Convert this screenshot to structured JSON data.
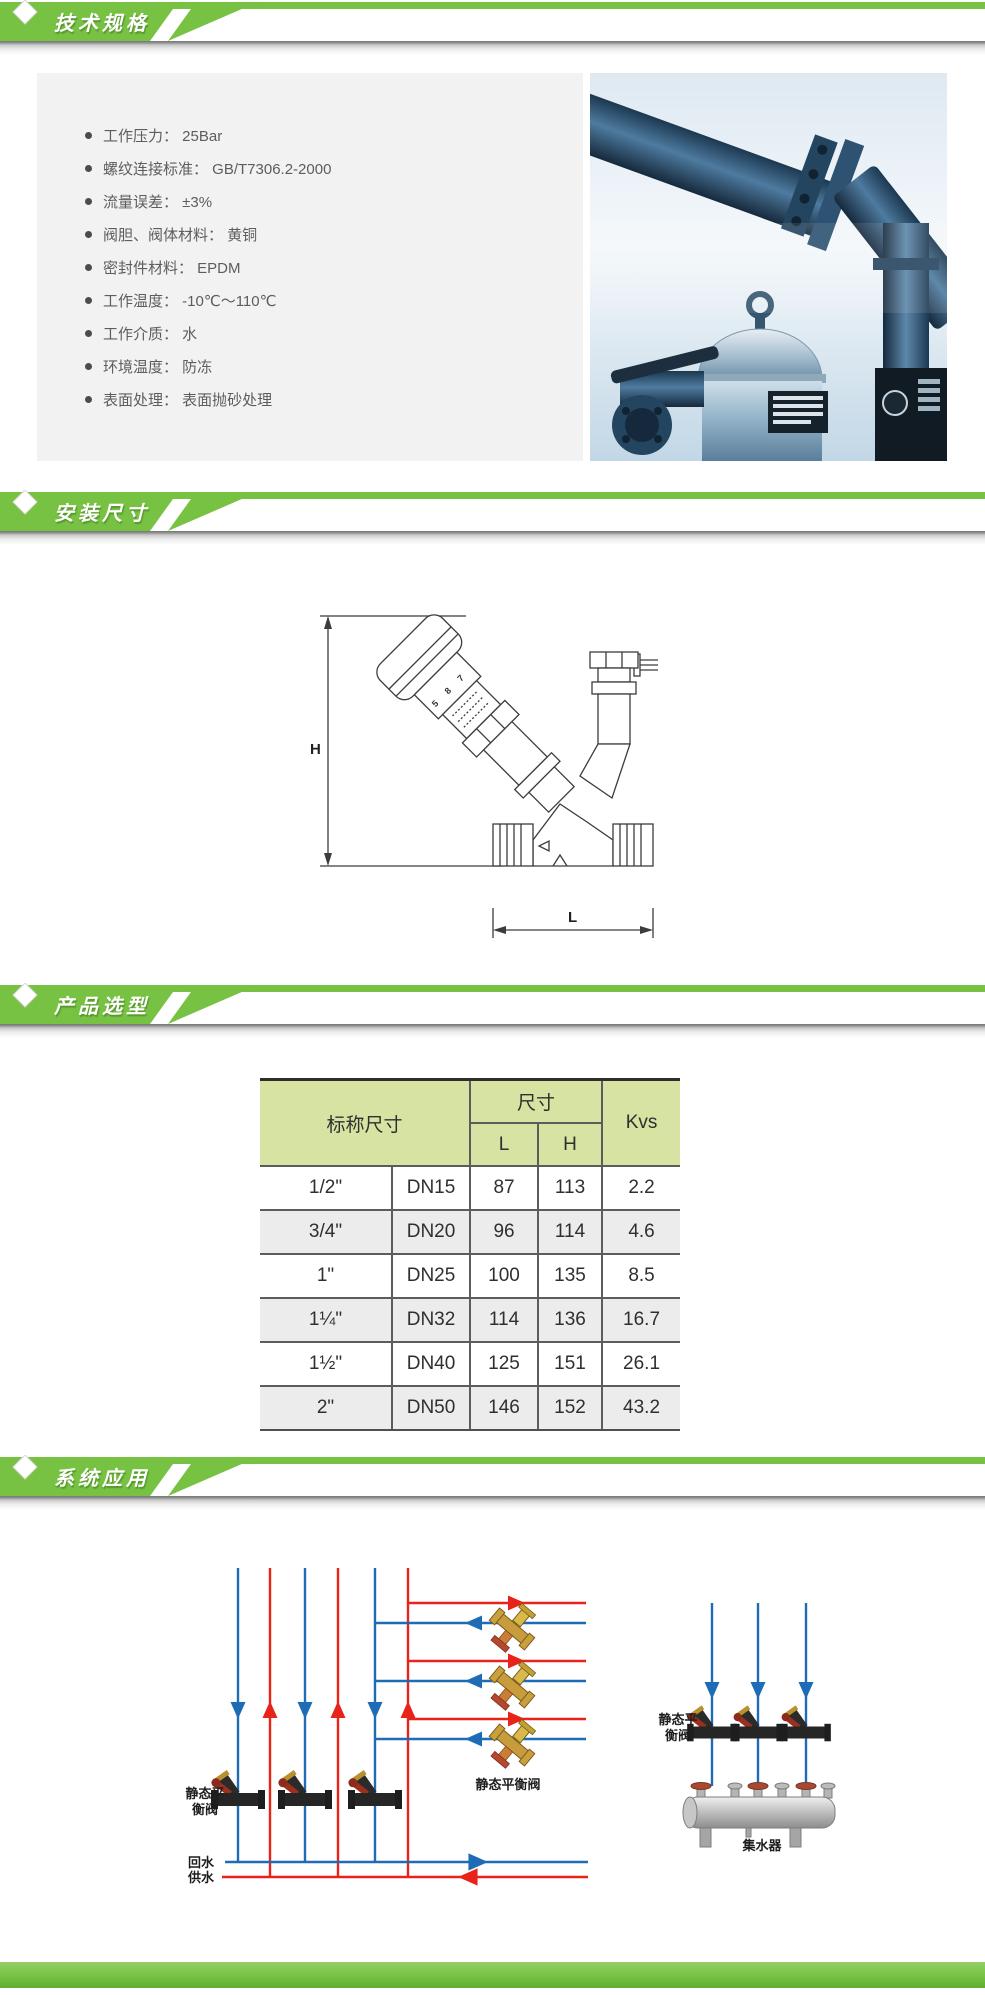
{
  "page": {
    "background": "#ffffff",
    "accent_green": "#77c143",
    "banner_text_color": "#ffffff",
    "panel_bg": "#f2f2f2"
  },
  "banners": {
    "specs": "技术规格",
    "install": "安装尺寸",
    "selection": "产品选型",
    "application": "系统应用"
  },
  "specs": {
    "items": [
      "工作压力： 25Bar",
      "螺纹连接标准： GB/T7306.2-2000",
      "流量误差： ±3%",
      "阀胆、阀体材料： 黄铜",
      "密封件材料： EPDM",
      "工作温度： -10℃～110℃",
      "工作介质： 水",
      "环境温度： 防冻",
      "表面处理： 表面抛砂处理"
    ]
  },
  "drawing": {
    "dim_height_label": "H",
    "dim_length_label": "L",
    "handle_digits": [
      "5",
      "8",
      "7"
    ]
  },
  "selection_table": {
    "header_bg": "#d6e3a3",
    "header": {
      "nominal": "标称尺寸",
      "size": "尺寸",
      "l": "L",
      "h": "H",
      "kvs": "Kvs"
    },
    "rows": [
      [
        "1/2\"",
        "DN15",
        "87",
        "113",
        "2.2"
      ],
      [
        "3/4\"",
        "DN20",
        "96",
        "114",
        "4.6"
      ],
      [
        "1\"",
        "DN25",
        "100",
        "135",
        "8.5"
      ],
      [
        "1¼\"",
        "DN32",
        "114",
        "136",
        "16.7"
      ],
      [
        "1½\"",
        "DN40",
        "125",
        "151",
        "26.1"
      ],
      [
        "2\"",
        "DN50",
        "146",
        "152",
        "43.2"
      ]
    ]
  },
  "application": {
    "supply_color": "#e8231a",
    "return_color": "#1e6cb5",
    "left_valves_label_line1": "静态平",
    "left_valves_label_line2": "衡阀",
    "branch_valves_label": "静态平衡阀",
    "right_valves_label_line1": "静态平",
    "right_valves_label_line2": "衡阀",
    "manifold_label": "集水器",
    "return_line_label": "回水",
    "supply_line_label": "供水"
  }
}
